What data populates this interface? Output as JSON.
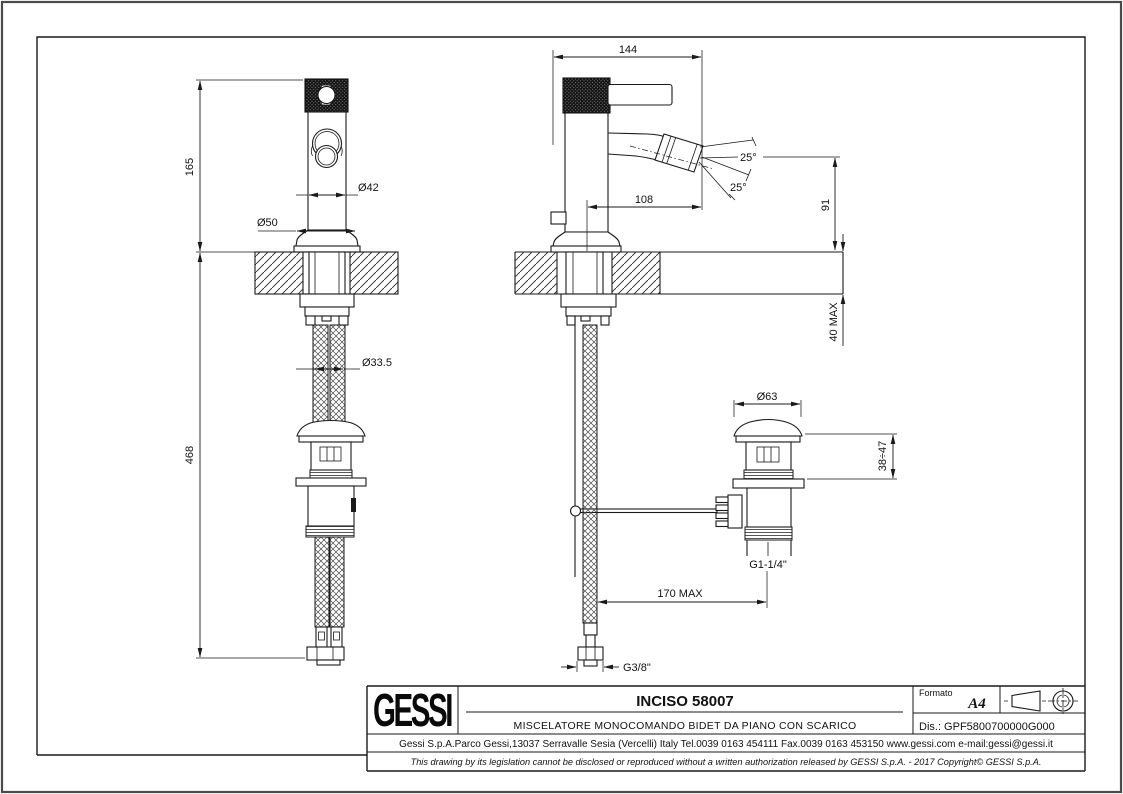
{
  "drawing": {
    "dims": {
      "spout_height": "165",
      "total_height": "468",
      "body_diameter": "Ø42",
      "base_diameter": "Ø50",
      "shank_diameter": "Ø33.5",
      "total_depth": "144",
      "spout_reach": "108",
      "spray_angle_upper": "25°",
      "spray_angle_lower": "25°",
      "aerator_height": "91",
      "deck_thickness_max": "40 MAX",
      "waste_cap_diameter": "Ø63",
      "waste_adjust_range": "38÷47",
      "waste_thread": "G1-1/4\"",
      "waste_offset_max": "170 MAX",
      "supply_thread": "G3/8\""
    },
    "title_block": {
      "brand": "GESSI",
      "product_code": "INCISO 58007",
      "description": "MISCELATORE MONOCOMANDO BIDET DA PIANO CON SCARICO",
      "format_label": "Formato",
      "format_value": "A4",
      "drawing_number_line": "Dis.: GPF5800700000G000",
      "company_line": "Gessi S.p.A.Parco Gessi,13037 Serravalle Sesia (Vercelli) Italy Tel.0039 0163 454111 Fax.0039 0163 453150 www.gessi.com e-mail:gessi@gessi.it",
      "legal_line": "This drawing by its legislation cannot be disclosed or reproduced without a written authorization released by GESSI S.p.A. - 2017 Copyright© GESSI S.p.A."
    }
  }
}
